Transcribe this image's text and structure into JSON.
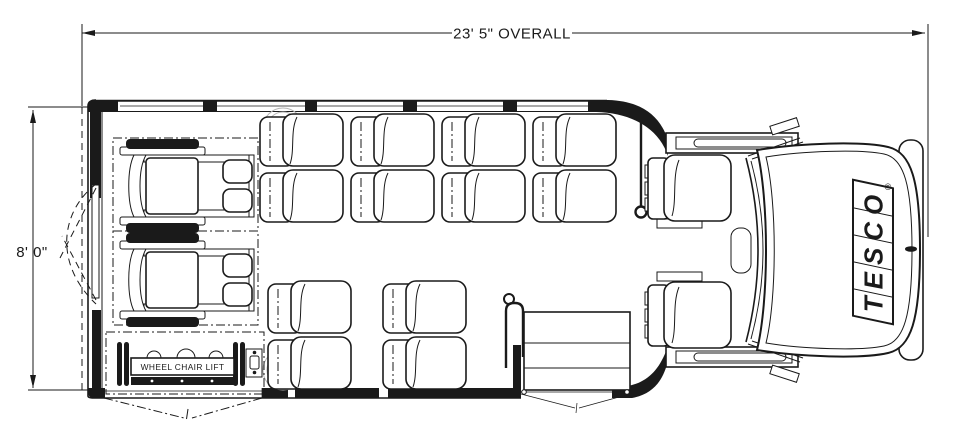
{
  "diagram": {
    "type": "wheelchair-shuttle-bus-floor-plan",
    "dimension_top": "23' 5\" OVERALL",
    "dimension_left": "8' 0\"",
    "lift_label": "WHEEL CHAIR LIFT",
    "brand": "TESCO",
    "registered_mark": "®"
  },
  "colors": {
    "ink": "#1a1a1a",
    "background": "#ffffff",
    "subtle_detail": "#b5b5b5"
  }
}
